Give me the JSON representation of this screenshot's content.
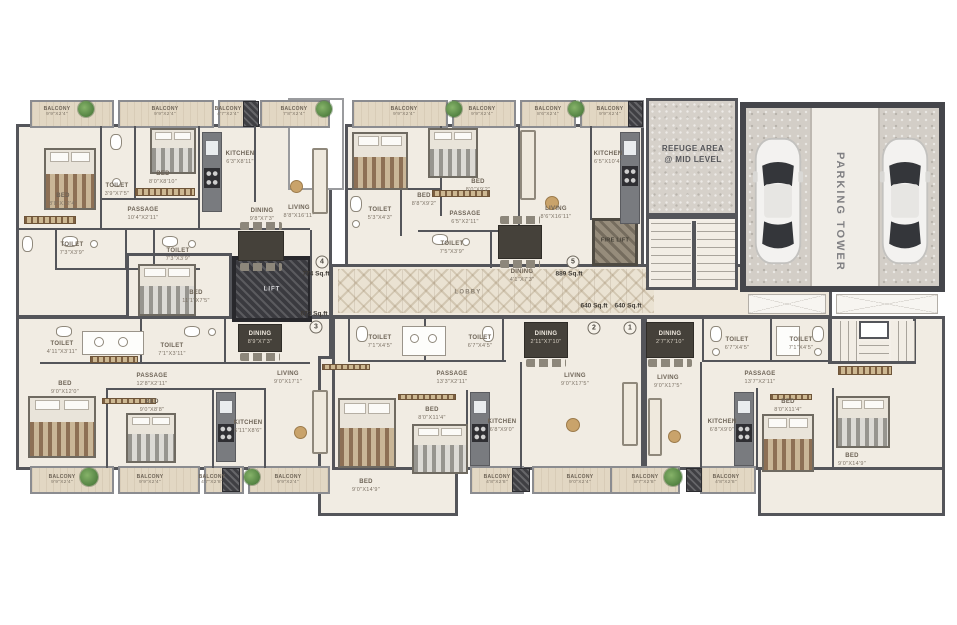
{
  "common": {
    "lobby": "LOBBY",
    "lift": "LIFT",
    "fire_lift": "FIRE LIFT",
    "refuge1": "REFUGE AREA",
    "refuge2": "@ MID LEVEL",
    "parking": "PARKING TOWER"
  },
  "areas": {
    "a1": {
      "num": "1",
      "sqft": "640 Sq.ft"
    },
    "a2": {
      "num": "2",
      "sqft": "640 Sq.ft"
    },
    "a3": {
      "num": "3",
      "sqft": "673 Sq.ft"
    },
    "a4": {
      "num": "4",
      "sqft": "774 Sq.ft"
    },
    "a5": {
      "num": "5",
      "sqft": "889 Sq.ft"
    }
  },
  "units": {
    "u4": {
      "balcony1": {
        "name": "BALCONY",
        "dims": "9'9\"x2'4\""
      },
      "balcony2": {
        "name": "BALCONY",
        "dims": "9'9\"x2'4\""
      },
      "balcony3": {
        "name": "BALCONY",
        "dims": "4'7\"x2'4\""
      },
      "balcony4": {
        "name": "BALCONY",
        "dims": "7'8\"x2'4\""
      },
      "bed1": {
        "name": "BED",
        "dims": "8'8\"x12'4\""
      },
      "bed2": {
        "name": "BED",
        "dims": "8'0\"x8'10\""
      },
      "toilet1": {
        "name": "TOILET",
        "dims": "3'9\"x7'5\""
      },
      "toilet2": {
        "name": "TOILET",
        "dims": "7'3\"x3'9\""
      },
      "toilet3": {
        "name": "TOILET",
        "dims": "7'3\"x3'9\""
      },
      "kitchen": {
        "name": "KITCHEN",
        "dims": "6'3\"x8'11\""
      },
      "living": {
        "name": "LIVING",
        "dims": "8'8\"x16'11\""
      },
      "passage": {
        "name": "PASSAGE",
        "dims": "10'4\"x2'11\""
      },
      "dining": {
        "name": "DINING",
        "dims": "9'8\"x7'3\""
      }
    },
    "u5": {
      "balcony1": {
        "name": "BALCONY",
        "dims": "9'9\"x2'4\""
      },
      "balcony2": {
        "name": "BALCONY",
        "dims": "9'9\"x2'4\""
      },
      "balcony3": {
        "name": "BALCONY",
        "dims": "8'6\"x2'4\""
      },
      "balcony4": {
        "name": "BALCONY",
        "dims": "9'9\"x2'4\""
      },
      "bed1": {
        "name": "BED",
        "dims": "8'8\"x9'2\""
      },
      "bed2": {
        "name": "BED",
        "dims": "8'0\"x9'2\""
      },
      "kitchen": {
        "name": "KITCHEN",
        "dims": "6'5\"x10'4\""
      },
      "toilet1": {
        "name": "TOILET",
        "dims": "5'3\"x4'3\""
      },
      "toilet2": {
        "name": "TOILET",
        "dims": "7'5\"x3'9\""
      },
      "passage": {
        "name": "PASSAGE",
        "dims": "6'5\"x2'11\""
      },
      "living": {
        "name": "LIVING",
        "dims": "8'6\"x16'11\""
      },
      "dining": {
        "name": "DINING",
        "dims": "4'1\"x7'3\""
      }
    },
    "u3": {
      "bed1": {
        "name": "BED",
        "dims": "11'1\"x7'5\""
      },
      "dining": {
        "name": "DINING",
        "dims": "8'9\"x7'3\""
      },
      "toilet1": {
        "name": "TOILET",
        "dims": "4'11\"x3'11\""
      },
      "toilet2": {
        "name": "TOILET",
        "dims": "7'1\"x3'11\""
      },
      "passage": {
        "name": "PASSAGE",
        "dims": "12'8\"x2'11\""
      },
      "bed2": {
        "name": "BED",
        "dims": "9'0\"x12'0\""
      },
      "bed3": {
        "name": "BED",
        "dims": "9'0\"x8'8\""
      },
      "kitchen": {
        "name": "KITCHEN",
        "dims": "6'11\"x8'6\""
      },
      "living": {
        "name": "LIVING",
        "dims": "9'0\"x17'1\""
      },
      "balcony1": {
        "name": "BALCONY",
        "dims": "9'9\"x2'4\""
      },
      "balcony2": {
        "name": "BALCONY",
        "dims": "9'9\"x2'4\""
      },
      "balcony3": {
        "name": "BALCONY",
        "dims": "4'7\"x2'8\""
      },
      "balcony4": {
        "name": "BALCONY",
        "dims": "9'9\"x2'4\""
      }
    },
    "u2": {
      "toilet1": {
        "name": "TOILET",
        "dims": "7'1\"x4'5\""
      },
      "toilet2": {
        "name": "TOILET",
        "dims": "6'7\"x4'5\""
      },
      "passage": {
        "name": "PASSAGE",
        "dims": "13'3\"x2'11\""
      },
      "dining": {
        "name": "DINING",
        "dims": "2'11\"x7'10\""
      },
      "living": {
        "name": "LIVING",
        "dims": "9'0\"x17'5\""
      },
      "bed1": {
        "name": "BED",
        "dims": "8'0\"x11'4\""
      },
      "bed2": {
        "name": "BED",
        "dims": "9'0\"x14'9\""
      },
      "kitchen": {
        "name": "KITCHEN",
        "dims": "6'8\"x9'0\""
      },
      "balcony1": {
        "name": "BALCONY",
        "dims": "4'8\"x2'8\""
      },
      "balcony2": {
        "name": "BALCONY",
        "dims": "9'0\"x2'4\""
      }
    },
    "u1": {
      "dining": {
        "name": "DINING",
        "dims": "2'7\"x7'10\""
      },
      "toilet1": {
        "name": "TOILET",
        "dims": "6'7\"x4'5\""
      },
      "toilet2": {
        "name": "TOILET",
        "dims": "7'1\"x4'5\""
      },
      "passage": {
        "name": "PASSAGE",
        "dims": "13'7\"x2'11\""
      },
      "living": {
        "name": "LIVING",
        "dims": "9'0\"x17'5\""
      },
      "kitchen": {
        "name": "KITCHEN",
        "dims": "6'8\"x9'0\""
      },
      "bed1": {
        "name": "BED",
        "dims": "8'0\"x11'4\""
      },
      "bed2": {
        "name": "BED",
        "dims": "9'0\"x14'9\""
      },
      "balcony1": {
        "name": "BALCONY",
        "dims": "8'7\"x2'8\""
      },
      "balcony2": {
        "name": "BALCONY",
        "dims": "4'8\"x2'8\""
      }
    }
  }
}
